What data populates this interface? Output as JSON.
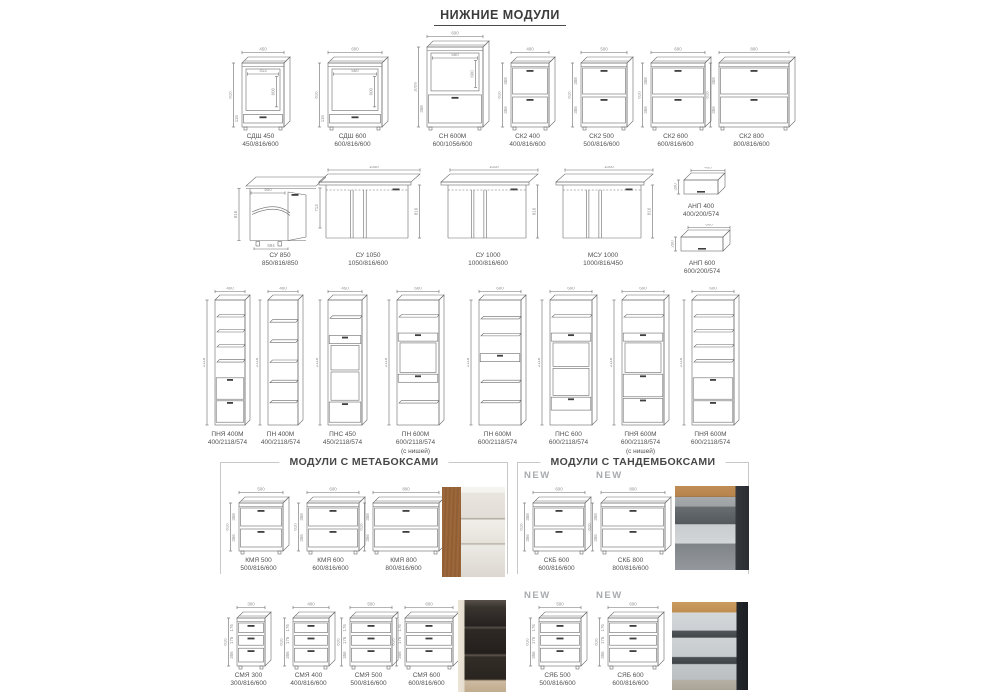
{
  "page": {
    "title": "НИЖНИЕ МОДУЛИ"
  },
  "sections": {
    "metabox": {
      "label": "МОДУЛИ С МЕТАБОКСАМИ"
    },
    "tandembox": {
      "label": "МОДУЛИ С ТАНДЕМБОКСАМИ"
    },
    "new_badge": "NEW"
  },
  "colors": {
    "line": "#6a6a6a",
    "dim_text": "#8f8f8f",
    "label_text": "#515151",
    "handle": "#3f3f3f",
    "bracket": "#c8c8c8",
    "new_badge": "#a7abaf"
  },
  "modules": [
    {
      "id": "sdsh-450",
      "name": "СДШ 450",
      "dims": "450/816/600",
      "type": "oven",
      "x": 229,
      "y": 47,
      "w": 63,
      "h": 84,
      "top": "450",
      "left": "816",
      "fronts": [
        {
          "k": "ni",
          "f": 0.8,
          "nw": "413",
          "nh": "600"
        },
        {
          "k": "dr",
          "f": 0.2,
          "d": "116"
        }
      ]
    },
    {
      "id": "sdsh-600",
      "name": "СДШ 600",
      "dims": "600/816/600",
      "type": "oven",
      "x": 315,
      "y": 47,
      "w": 75,
      "h": 84,
      "top": "600",
      "left": "816",
      "fronts": [
        {
          "k": "ni",
          "f": 0.8,
          "nw": "560",
          "nh": "600"
        },
        {
          "k": "dr",
          "f": 0.2,
          "d": "116"
        }
      ]
    },
    {
      "id": "sn-600m",
      "name": "СН 600М",
      "dims": "600/1056/600",
      "type": "oven",
      "x": 414,
      "y": 31,
      "w": 77,
      "h": 100,
      "top": "600",
      "left": "1056",
      "fronts": [
        {
          "k": "ni",
          "f": 0.58,
          "nw": "560",
          "nh": "600"
        },
        {
          "k": "dr",
          "f": 0.42,
          "d": "358"
        }
      ]
    },
    {
      "id": "sk2-400",
      "name": "СК2 400",
      "dims": "400/816/600",
      "type": "k2",
      "x": 498,
      "y": 47,
      "w": 59,
      "h": 84,
      "top": "400",
      "left": "816",
      "fronts": [
        {
          "k": "dr",
          "f": 0.5,
          "d": "358"
        },
        {
          "k": "dr",
          "f": 0.5,
          "d": "356"
        }
      ]
    },
    {
      "id": "sk2-500",
      "name": "СК2 500",
      "dims": "500/816/600",
      "type": "k2",
      "x": 568,
      "y": 47,
      "w": 67,
      "h": 84,
      "top": "500",
      "left": "816",
      "fronts": [
        {
          "k": "dr",
          "f": 0.5,
          "d": "358"
        },
        {
          "k": "dr",
          "f": 0.5,
          "d": "356"
        }
      ]
    },
    {
      "id": "sk2-600",
      "name": "СК2 600",
      "dims": "600/816/600",
      "type": "k2",
      "x": 638,
      "y": 47,
      "w": 75,
      "h": 84,
      "top": "600",
      "left": "816",
      "fronts": [
        {
          "k": "dr",
          "f": 0.5,
          "d": "358"
        },
        {
          "k": "dr",
          "f": 0.5,
          "d": "356"
        }
      ]
    },
    {
      "id": "sk2-800",
      "name": "СК2 800",
      "dims": "800/816/600",
      "type": "k2",
      "x": 706,
      "y": 47,
      "w": 91,
      "h": 84,
      "top": "800",
      "left": "816",
      "fronts": [
        {
          "k": "dr",
          "f": 0.5,
          "d": "358"
        },
        {
          "k": "dr",
          "f": 0.5,
          "d": "356"
        }
      ]
    },
    {
      "id": "su-850",
      "name": "СУ 850",
      "dims": "850/816/850",
      "type": "corner850",
      "x": 234,
      "y": 166,
      "w": 92,
      "h": 84,
      "top": "500",
      "left": "816",
      "right": "713",
      "bot": "594"
    },
    {
      "id": "su-1050",
      "name": "СУ 1050",
      "dims": "1050/816/600",
      "type": "cornerw",
      "x": 313,
      "y": 166,
      "w": 110,
      "h": 84,
      "top": "1050",
      "right": "816"
    },
    {
      "id": "su-1000",
      "name": "СУ 1000",
      "dims": "1000/816/600",
      "type": "cornerw",
      "x": 435,
      "y": 166,
      "w": 106,
      "h": 84,
      "top": "1000",
      "right": "816"
    },
    {
      "id": "msu-1000",
      "name": "МСУ 1000",
      "dims": "1000/816/450",
      "type": "cornerw",
      "x": 550,
      "y": 166,
      "w": 106,
      "h": 84,
      "top": "1000",
      "right": "816"
    },
    {
      "id": "anp-400",
      "name": "АНП 400",
      "dims": "400/200/574",
      "type": "anp",
      "x": 674,
      "y": 167,
      "w": 54,
      "h": 34,
      "top": "400",
      "left": "200"
    },
    {
      "id": "anp-600",
      "name": "АНП 600",
      "dims": "600/200/574",
      "type": "anp",
      "x": 671,
      "y": 224,
      "w": 62,
      "h": 34,
      "top": "600",
      "left": "200"
    },
    {
      "id": "pnya-400m",
      "name": "ПНЯ 400М",
      "dims": "400/2118/574",
      "type": "tall",
      "x": 203,
      "y": 287,
      "w": 49,
      "h": 142,
      "top": "400",
      "left": "2118",
      "seg": [
        [
          "sh",
          0.62,
          4
        ],
        [
          "dr",
          0.19,
          0
        ],
        [
          "dr",
          0.19,
          0
        ]
      ]
    },
    {
      "id": "pn-400m",
      "name": "ПН 400М",
      "dims": "400/2118/574",
      "type": "tall",
      "x": 256,
      "y": 287,
      "w": 49,
      "h": 142,
      "top": "400",
      "left": "2118",
      "seg": [
        [
          "sh",
          1,
          5
        ]
      ]
    },
    {
      "id": "pns-450",
      "name": "ПНС 450",
      "dims": "450/2118/574",
      "type": "tall",
      "x": 316,
      "y": 287,
      "w": 53,
      "h": 142,
      "top": "450",
      "left": "2118",
      "seg": [
        [
          "sh",
          0.27,
          1
        ],
        [
          "dr",
          0.08,
          0
        ],
        [
          "ni",
          0.22,
          0
        ],
        [
          "ni",
          0.25,
          0
        ],
        [
          "dr",
          0.18,
          0
        ]
      ]
    },
    {
      "id": "pn-600m-nisha",
      "name": "ПН 600М",
      "dims": "600/2118/574",
      "note": "(с нишей)",
      "type": "tall",
      "x": 385,
      "y": 287,
      "w": 61,
      "h": 142,
      "top": "600",
      "left": "2118",
      "seg": [
        [
          "sh",
          0.25,
          1
        ],
        [
          "dr",
          0.08,
          0
        ],
        [
          "ni",
          0.26,
          0
        ],
        [
          "dr",
          0.08,
          0
        ],
        [
          "sh",
          0.33,
          1
        ]
      ]
    },
    {
      "id": "pn-600m",
      "name": "ПН 600М",
      "dims": "600/2118/574",
      "type": "tall",
      "x": 467,
      "y": 287,
      "w": 61,
      "h": 142,
      "top": "600",
      "left": "2118",
      "seg": [
        [
          "sh",
          0.42,
          2
        ],
        [
          "dr",
          0.08,
          0
        ],
        [
          "sh",
          0.5,
          2
        ]
      ]
    },
    {
      "id": "pns-600",
      "name": "ПНС 600",
      "dims": "600/2118/574",
      "type": "tall",
      "x": 538,
      "y": 287,
      "w": 61,
      "h": 142,
      "top": "600",
      "left": "2118",
      "seg": [
        [
          "sh",
          0.25,
          1
        ],
        [
          "dr",
          0.08,
          0
        ],
        [
          "ni",
          0.21,
          0
        ],
        [
          "ni",
          0.24,
          0
        ],
        [
          "dr",
          0.12,
          0
        ],
        [
          "sh",
          0.1,
          0
        ]
      ]
    },
    {
      "id": "pnya-600m-nisha",
      "name": "ПНЯ 600М",
      "dims": "600/2118/574",
      "note": "(с нишей)",
      "type": "tall",
      "x": 610,
      "y": 287,
      "w": 61,
      "h": 142,
      "top": "600",
      "left": "2118",
      "seg": [
        [
          "sh",
          0.25,
          1
        ],
        [
          "dr",
          0.08,
          0
        ],
        [
          "ni",
          0.26,
          0
        ],
        [
          "dr",
          0.2,
          0
        ],
        [
          "dr",
          0.21,
          0
        ]
      ]
    },
    {
      "id": "pnya-600m",
      "name": "ПНЯ 600М",
      "dims": "600/2118/574",
      "type": "tall",
      "x": 680,
      "y": 287,
      "w": 61,
      "h": 142,
      "top": "600",
      "left": "2118",
      "seg": [
        [
          "sh",
          0.62,
          4
        ],
        [
          "dr",
          0.19,
          0
        ],
        [
          "dr",
          0.19,
          0
        ]
      ]
    },
    {
      "id": "kmya-500",
      "name": "КМЯ 500",
      "dims": "500/816/600",
      "type": "k2",
      "x": 226,
      "y": 487,
      "w": 65,
      "h": 68,
      "top": "500",
      "left": "816",
      "fronts": [
        {
          "k": "dr",
          "f": 0.5,
          "d": "358"
        },
        {
          "k": "dr",
          "f": 0.5,
          "d": "356"
        }
      ]
    },
    {
      "id": "kmya-600",
      "name": "КМЯ 600",
      "dims": "600/816/600",
      "type": "k2",
      "x": 294,
      "y": 487,
      "w": 73,
      "h": 68,
      "top": "600",
      "left": "816",
      "fronts": [
        {
          "k": "dr",
          "f": 0.5,
          "d": "358"
        },
        {
          "k": "dr",
          "f": 0.5,
          "d": "356"
        }
      ]
    },
    {
      "id": "kmya-800",
      "name": "КМЯ 800",
      "dims": "800/816/600",
      "type": "k2",
      "x": 360,
      "y": 487,
      "w": 87,
      "h": 68,
      "top": "800",
      "left": "816",
      "fronts": [
        {
          "k": "dr",
          "f": 0.5,
          "d": "358"
        },
        {
          "k": "dr",
          "f": 0.5,
          "d": "356"
        }
      ]
    },
    {
      "id": "skb-600",
      "name": "СКБ 600",
      "dims": "600/816/600",
      "type": "k2",
      "x": 520,
      "y": 487,
      "w": 73,
      "h": 68,
      "top": "600",
      "left": "816",
      "fronts": [
        {
          "k": "dr",
          "f": 0.5,
          "d": "358"
        },
        {
          "k": "dr",
          "f": 0.5,
          "d": "356"
        }
      ]
    },
    {
      "id": "skb-800",
      "name": "СКБ 800",
      "dims": "800/816/600",
      "type": "k2",
      "x": 588,
      "y": 487,
      "w": 85,
      "h": 68,
      "top": "800",
      "left": "816",
      "fronts": [
        {
          "k": "dr",
          "f": 0.5,
          "d": "358"
        },
        {
          "k": "dr",
          "f": 0.5,
          "d": "356"
        }
      ]
    },
    {
      "id": "smya-300",
      "name": "СМЯ 300",
      "dims": "300/816/600",
      "type": "m3",
      "x": 224,
      "y": 602,
      "w": 49,
      "h": 68,
      "top": "300",
      "left": "816",
      "fronts": [
        {
          "k": "dr",
          "f": 0.3,
          "d": "176"
        },
        {
          "k": "dr",
          "f": 0.3,
          "d": "176"
        },
        {
          "k": "dr",
          "f": 0.4,
          "d": "356"
        }
      ]
    },
    {
      "id": "smya-400",
      "name": "СМЯ 400",
      "dims": "400/816/600",
      "type": "m3",
      "x": 280,
      "y": 602,
      "w": 57,
      "h": 68,
      "top": "400",
      "left": "816",
      "fronts": [
        {
          "k": "dr",
          "f": 0.3,
          "d": "176"
        },
        {
          "k": "dr",
          "f": 0.3,
          "d": "176"
        },
        {
          "k": "dr",
          "f": 0.4,
          "d": "356"
        }
      ]
    },
    {
      "id": "smya-500",
      "name": "СМЯ 500",
      "dims": "500/816/600",
      "type": "m3",
      "x": 337,
      "y": 602,
      "w": 63,
      "h": 68,
      "top": "500",
      "left": "816",
      "fronts": [
        {
          "k": "dr",
          "f": 0.3,
          "d": "176"
        },
        {
          "k": "dr",
          "f": 0.3,
          "d": "176"
        },
        {
          "k": "dr",
          "f": 0.4,
          "d": "356"
        }
      ]
    },
    {
      "id": "smya-600",
      "name": "СМЯ 600",
      "dims": "600/816/600",
      "type": "m3",
      "x": 392,
      "y": 602,
      "w": 69,
      "h": 68,
      "top": "600",
      "left": "816",
      "fronts": [
        {
          "k": "dr",
          "f": 0.3,
          "d": "176"
        },
        {
          "k": "dr",
          "f": 0.3,
          "d": "176"
        },
        {
          "k": "dr",
          "f": 0.4,
          "d": "356"
        }
      ]
    },
    {
      "id": "syab-500",
      "name": "СЯБ 500",
      "dims": "500/816/600",
      "type": "m3",
      "x": 526,
      "y": 602,
      "w": 63,
      "h": 68,
      "top": "500",
      "left": "816",
      "fronts": [
        {
          "k": "dr",
          "f": 0.3,
          "d": "176"
        },
        {
          "k": "dr",
          "f": 0.3,
          "d": "176"
        },
        {
          "k": "dr",
          "f": 0.4,
          "d": "356"
        }
      ]
    },
    {
      "id": "syab-600",
      "name": "СЯБ 600",
      "dims": "600/816/600",
      "type": "m3",
      "x": 595,
      "y": 602,
      "w": 71,
      "h": 68,
      "top": "600",
      "left": "816",
      "fronts": [
        {
          "k": "dr",
          "f": 0.3,
          "d": "176"
        },
        {
          "k": "dr",
          "f": 0.3,
          "d": "176"
        },
        {
          "k": "dr",
          "f": 0.4,
          "d": "356"
        }
      ]
    }
  ],
  "photos": [
    {
      "id": "metabox-photo-1",
      "kind": "metabox-a",
      "x": 442,
      "y": 487,
      "w": 63,
      "h": 90
    },
    {
      "id": "tandembox-photo-1",
      "kind": "tandembox-a",
      "x": 675,
      "y": 486,
      "w": 74,
      "h": 84
    },
    {
      "id": "metabox-photo-2",
      "kind": "metabox-b",
      "x": 458,
      "y": 600,
      "w": 48,
      "h": 92
    },
    {
      "id": "tandembox-photo-2",
      "kind": "tandembox-b",
      "x": 672,
      "y": 602,
      "w": 76,
      "h": 88
    }
  ],
  "badges": [
    {
      "x": 524,
      "y": 470
    },
    {
      "x": 596,
      "y": 470
    },
    {
      "x": 524,
      "y": 590
    },
    {
      "x": 596,
      "y": 590
    }
  ]
}
